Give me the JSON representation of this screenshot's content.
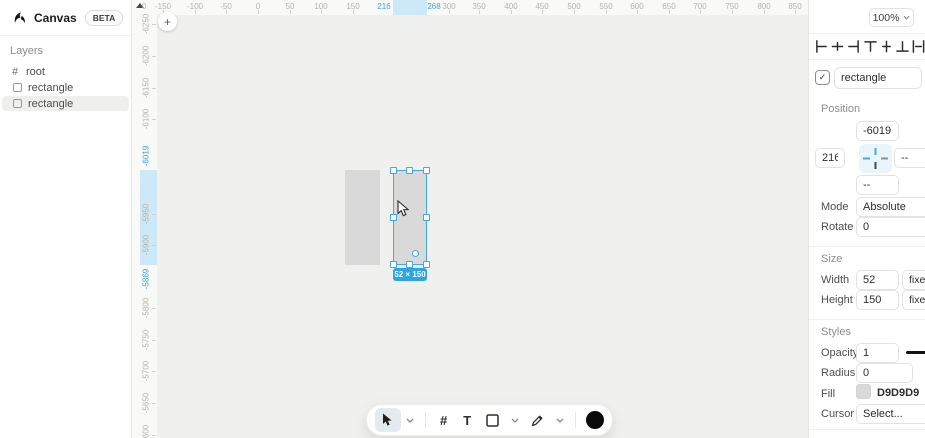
{
  "app": {
    "title": "Canvas",
    "beta_badge": "BETA"
  },
  "layers_panel": {
    "header": "Layers",
    "items": [
      {
        "glyph": "#",
        "label": "root"
      },
      {
        "label": "rectangle"
      },
      {
        "label": "rectangle",
        "selected": true
      }
    ]
  },
  "canvas": {
    "corner_label": "0",
    "plus_label": "+",
    "selection": {
      "badge": "52 × 150",
      "x": 216,
      "y": -6019,
      "width": 52,
      "height": 150
    },
    "h_ruler": {
      "gray_labels": [
        {
          "t": "-150",
          "x": 163
        },
        {
          "t": "-100",
          "x": 195
        },
        {
          "t": "-50",
          "x": 226
        },
        {
          "t": "0",
          "x": 258
        },
        {
          "t": "50",
          "x": 290
        },
        {
          "t": "100",
          "x": 321
        },
        {
          "t": "150",
          "x": 353
        },
        {
          "t": "300",
          "x": 449
        },
        {
          "t": "350",
          "x": 479
        },
        {
          "t": "400",
          "x": 511
        },
        {
          "t": "450",
          "x": 542
        },
        {
          "t": "500",
          "x": 574
        },
        {
          "t": "550",
          "x": 606
        },
        {
          "t": "600",
          "x": 637
        },
        {
          "t": "650",
          "x": 669
        },
        {
          "t": "700",
          "x": 700
        },
        {
          "t": "750",
          "x": 732
        },
        {
          "t": "800",
          "x": 764
        },
        {
          "t": "850",
          "x": 795
        }
      ],
      "blue_start": {
        "t": "216",
        "x": 384
      },
      "blue_end": {
        "t": "268",
        "x": 434
      },
      "band": {
        "x": 393,
        "w": 34
      }
    },
    "v_ruler": {
      "gray_labels": [
        {
          "t": "-6250",
          "y": 24
        },
        {
          "t": "-6200",
          "y": 56
        },
        {
          "t": "-6150",
          "y": 88
        },
        {
          "t": "-6100",
          "y": 119
        },
        {
          "t": "-5950",
          "y": 214
        },
        {
          "t": "-5900",
          "y": 245
        },
        {
          "t": "-5800",
          "y": 308
        },
        {
          "t": "-5750",
          "y": 340
        },
        {
          "t": "-5700",
          "y": 371
        },
        {
          "t": "-5650",
          "y": 403
        },
        {
          "t": "-5600",
          "y": 435
        }
      ],
      "blue_start": {
        "t": "-6019",
        "y": 156
      },
      "blue_end": {
        "t": "-5869",
        "y": 279
      },
      "band": {
        "y": 170,
        "h": 95
      }
    }
  },
  "toolbar": {
    "hash_label": "#",
    "text_label": "T"
  },
  "inspector": {
    "zoom_value": "100%",
    "name_row": {
      "check_glyph": "✓",
      "value": "rectangle"
    },
    "position": {
      "header": "Position",
      "y_value": "-6019",
      "x_value": "216",
      "right_value": "--",
      "bottom_value": "--",
      "mode_label": "Mode",
      "mode_value": "Absolute",
      "rotate_label": "Rotate",
      "rotate_value": "0"
    },
    "size": {
      "header": "Size",
      "width_label": "Width",
      "width_value": "52",
      "width_mode": "fixed",
      "height_label": "Height",
      "height_value": "150",
      "height_mode": "fixed"
    },
    "styles": {
      "header": "Styles",
      "opacity_label": "Opacity",
      "opacity_value": "1",
      "radius_label": "Radius",
      "radius_value": "0",
      "fill_label": "Fill",
      "fill_value": "D9D9D9",
      "fill_style": "background:#D9D9D9",
      "cursor_label": "Cursor",
      "cursor_value": "Select..."
    }
  },
  "colors": {
    "selection_blue": "#43ABE1",
    "badge_blue": "#2EA5E0",
    "ruler_band": "#CDE8F6",
    "rect_fill": "#D9D9D9",
    "canvas_bg": "#F0F0EE"
  }
}
